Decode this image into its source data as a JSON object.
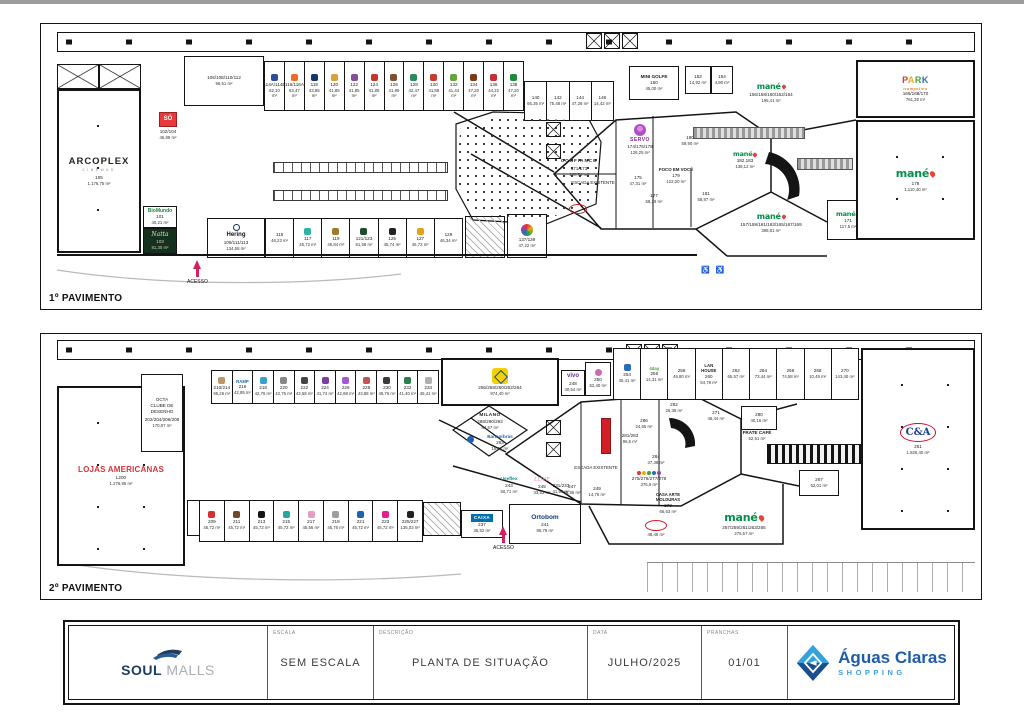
{
  "floor1": {
    "label": "1º PAVIMENTO",
    "acesso": "ACESSO",
    "escada": "ESCADA EXISTENTE",
    "arcoplex": {
      "name": "ARCOPLEX",
      "sub": "CINEMAS",
      "num": "105",
      "area": "1.176,75 m²"
    },
    "room106": {
      "num": "106/108/110/112",
      "area": "96,51 m²"
    },
    "so": {
      "name": "SÓ",
      "num": "102/104",
      "area": "46,89 m²"
    },
    "biomundo": {
      "name": "BioMundo",
      "num": "101",
      "area": "40,21 m²"
    },
    "natta": {
      "name": "Natta",
      "num": "103",
      "area": "81,30 m²"
    },
    "hering": {
      "name": "Hering",
      "num": "109/111/113",
      "area": "134,58 m²"
    },
    "top_row": [
      {
        "num": "114A/114B",
        "area": "62,10 m²",
        "logo": "#2b4d9b"
      },
      {
        "num": "116/116A",
        "area": "63,47 m²",
        "logo": "#f26a21"
      },
      {
        "num": "118",
        "area": "43,85 m²",
        "logo": "#16336e"
      },
      {
        "num": "120",
        "area": "41,85 m²",
        "logo": "#d8a13a"
      },
      {
        "num": "122",
        "area": "41,85 m²",
        "logo": "#8a4b9c"
      },
      {
        "num": "124",
        "area": "41,89 m²",
        "logo": "#c0392b"
      },
      {
        "num": "126",
        "area": "41,89 m²",
        "logo": "#7a5230"
      },
      {
        "num": "128",
        "area": "42,47 m²",
        "logo": "#2e8b57"
      },
      {
        "num": "130",
        "area": "41,88 m²",
        "logo": "#c73b2b"
      },
      {
        "num": "132",
        "area": "41,44 m²",
        "logo": "#66a33a"
      },
      {
        "num": "134",
        "area": "47,20 m²",
        "logo": "#7a3b12"
      },
      {
        "num": "136",
        "area": "44,22 m²",
        "logo": "#c62f2f"
      },
      {
        "num": "138",
        "area": "47,20 m²",
        "logo": "#1d8a3c"
      }
    ],
    "mid_row": [
      {
        "num": "140",
        "area": "65,35 m²"
      },
      {
        "num": "142",
        "area": "75,48 m²"
      },
      {
        "num": "144",
        "area": "47,28 m²"
      },
      {
        "num": "146",
        "area": "14,42 m²"
      }
    ],
    "bottom_row": [
      {
        "num": "115",
        "area": "46,23 m²"
      },
      {
        "num": "117",
        "area": "45,72 m²",
        "logo": "#2bb3a3"
      },
      {
        "num": "119",
        "area": "46,84 m²",
        "logo": "#9c7b2d"
      },
      {
        "num": "121/123",
        "area": "91,58 m²",
        "logo": "#1e4d2b"
      },
      {
        "num": "125",
        "area": "45,74 m²",
        "logo": "#222222"
      },
      {
        "num": "127",
        "area": "45,72 m²",
        "logo": "#e0a321"
      },
      {
        "num": "129",
        "area": "46,34 m²"
      }
    ],
    "store137": {
      "num": "137/139",
      "area": "47,22 m²"
    },
    "minigolfe": {
      "name": "MINI GOLFE",
      "num": "150",
      "area": "45,00 m²"
    },
    "store152": {
      "num": "152",
      "area": "14,92 m²"
    },
    "store154": {
      "num": "154",
      "area": "4,90 m²"
    },
    "confiance": {
      "name": "CONFIANCE",
      "num": "171/173",
      "area": "128,74 m²"
    },
    "servo": {
      "name": "SERVO",
      "num": "174/176/178",
      "area": "128,25 m²"
    },
    "store175": {
      "num": "175",
      "area": "47,31 m²"
    },
    "store177": {
      "num": "177",
      "area": "58,29 m²"
    },
    "foco": {
      "name": "FOCO EM VOCÊ",
      "num": "179",
      "area": "122,00 m²"
    },
    "store180": {
      "num": "180",
      "area": "59,90 m²"
    },
    "store181": {
      "num": "181",
      "area": "58,87 m²"
    },
    "mane_escada": {
      "name": "mané",
      "num": "182,183",
      "area": "138,12 m²"
    },
    "mane_top": {
      "name": "mané",
      "num": "156/158/160/162/164",
      "area": "195,41 m²"
    },
    "mane_bottom": {
      "name": "mané",
      "num": "157/159/161/163/165/167/169",
      "area": "398,81 m²"
    },
    "mane_171": {
      "name": "mané",
      "num": "171",
      "area": "117,5 m²"
    },
    "mane_178": {
      "name": "mané",
      "num": "178",
      "area": "1.110,40 m²"
    },
    "park": {
      "name": "PARK",
      "sub": "trampolins",
      "num": "166/168/170",
      "area": "761,30 m²"
    }
  },
  "floor2": {
    "label": "2º PAVIMENTO",
    "acesso": "ACESSO",
    "escada": "ESCADA EXISTENTE",
    "lojas_americanas": {
      "name": "LOJAS AMERICANAS",
      "num": "L200",
      "area": "1.276,95 m²"
    },
    "octa": {
      "l1": "OCTA",
      "l2": "CLUBE DE",
      "l3": "DESENHO",
      "num": "202/204/206/208",
      "area": "170,87 m²"
    },
    "store201": {
      "num": "201/203",
      "area": "180,56 m²"
    },
    "top_row": [
      {
        "num": "210/214",
        "area": "95,26 m²",
        "logo": "#b99767"
      },
      {
        "num": "216",
        "area": "42,85 m²",
        "name": "RAMP",
        "name_color": "#1b62b5"
      },
      {
        "num": "218",
        "area": "42,76 m²",
        "logo": "#39a0c8"
      },
      {
        "num": "220",
        "area": "42,76 m²",
        "logo": "#888888"
      },
      {
        "num": "222",
        "area": "43,68 m²",
        "logo": "#444444"
      },
      {
        "num": "224",
        "area": "41,74 m²",
        "logo": "#7a3f9c"
      },
      {
        "num": "226",
        "area": "42,88 m²",
        "logo": "#a45ad0"
      },
      {
        "num": "228",
        "area": "43,88 m²",
        "logo": "#c65353"
      },
      {
        "num": "230",
        "area": "45,76 m²",
        "logo": "#3a3a3a"
      },
      {
        "num": "232",
        "area": "41,40 m²",
        "logo": "#2d7d4f"
      },
      {
        "num": "234",
        "area": "45,41 m²",
        "logo": "#b0b0b0"
      }
    ],
    "bb": {
      "num": "256/258/260/262/264",
      "area": "974,40 m²"
    },
    "vivo": {
      "name": "vivo",
      "num": "248",
      "area": "40,54 m²"
    },
    "store250": {
      "num": "250",
      "area": "52,40 m²"
    },
    "topright_row": [
      {
        "num": "254",
        "area": "45,41 m²",
        "logo": "#2b6cb8"
      },
      {
        "num": "256",
        "area": "14,31 m²",
        "name": "4day",
        "name_color": "#3fa535"
      },
      {
        "num": "258",
        "area": "46,80 m²"
      },
      {
        "num": "260",
        "area": "54,78 m²",
        "name": "LAN HOUSE",
        "name_color": "#222222"
      },
      {
        "num": "262",
        "area": "65,57 m²"
      },
      {
        "num": "264",
        "area": "73,44 m²"
      },
      {
        "num": "266",
        "area": "74,58 m²"
      },
      {
        "num": "268",
        "area": "10,49 m²"
      },
      {
        "num": "270",
        "area": "143,40 m²"
      }
    ],
    "milano": {
      "name": "MILANO",
      "num": "288/290/292",
      "area": "84,57 m²"
    },
    "bancorbras": {
      "name": "Bancorbrás",
      "num": "293",
      "area": "18,91 m²"
    },
    "san": {
      "num": "231/233",
      "area": "41,99 m²"
    },
    "bottom_row": [
      {
        "num": "209",
        "area": "45,72 m²",
        "logo": "#d82f2f"
      },
      {
        "num": "211",
        "area": "45,72 m²",
        "logo": "#6b4a2b"
      },
      {
        "num": "213",
        "area": "45,72 m²",
        "logo": "#141414"
      },
      {
        "num": "215",
        "area": "45,72 m²",
        "logo": "#1faaa0"
      },
      {
        "num": "217",
        "area": "45,56 m²",
        "logo": "#e59ec2"
      },
      {
        "num": "219",
        "area": "45,76 m²",
        "logo": "#9aa0a6"
      },
      {
        "num": "221",
        "area": "45,72 m²",
        "logo": "#1b62b5"
      },
      {
        "num": "223",
        "area": "45,72 m²",
        "logo": "#e0218a"
      },
      {
        "num": "225/227",
        "area": "135,03 m²",
        "logo": "#222222"
      }
    ],
    "caixa": {
      "name": "CAIXA",
      "num": "237",
      "area": "36,52 m²"
    },
    "ortobom": {
      "name": "Ortobom",
      "num": "241",
      "area": "86,79 m²"
    },
    "useflex": {
      "name": "Useflex",
      "num": "243",
      "area": "50,71 m²"
    },
    "love": {
      "name": "LOVE",
      "num": "245",
      "area": "33,53 m²"
    },
    "store247": {
      "num": "247",
      "area": "36,86 m²"
    },
    "store249": {
      "num": "249",
      "area": "14,76 m²"
    },
    "store271": {
      "num": "271",
      "area": "46,44 m²"
    },
    "store280": {
      "num": "280",
      "area": "40,16 m²"
    },
    "store282": {
      "num": "282",
      "area": "26,36 m²"
    },
    "store284": {
      "num": "284",
      "area": "37,38 m²"
    },
    "store286": {
      "num": "286",
      "area": "24,65 m²"
    },
    "redstore": {
      "num": "281/283",
      "area": "96,5 m²"
    },
    "redoval_store": {
      "area": "48,46 m²"
    },
    "toy": {
      "num": "275/276/277/278",
      "area": "376,9 m²"
    },
    "casa_arte": {
      "l1": "CASA ARTE",
      "l2": "MOLDURAS",
      "num": "273",
      "area": "66,63 m²"
    },
    "frate": {
      "name": "FRATE CAFÉ",
      "area": "52,51 m²"
    },
    "store267": {
      "num": "267",
      "area": "52,01 m²"
    },
    "mane": {
      "name": "mané",
      "num": "257/259/261/263/265",
      "area": "275,57 m²"
    },
    "cea": {
      "name": "C&A",
      "num": "251",
      "area": "1.826,40 m²"
    }
  },
  "title_block": {
    "soul": {
      "word1": "SOUL",
      "word2": "MALLS"
    },
    "escala_label": "ESCALA",
    "escala_value": "SEM ESCALA",
    "descricao_label": "DESCRIÇÃO",
    "descricao_value": "PLANTA DE SITUAÇÃO",
    "data_label": "DATA",
    "data_value": "JULHO/2025",
    "pranchas_label": "PRANCHAS",
    "pranchas_value": "01/01",
    "brand": {
      "name": "Águas Claras",
      "sub": "SHOPPING"
    }
  },
  "colors": {
    "accent_red": "#d3215d",
    "mane_green": "#009048",
    "la_red": "#d6343b",
    "brand_blue": "#1d5ca8"
  }
}
